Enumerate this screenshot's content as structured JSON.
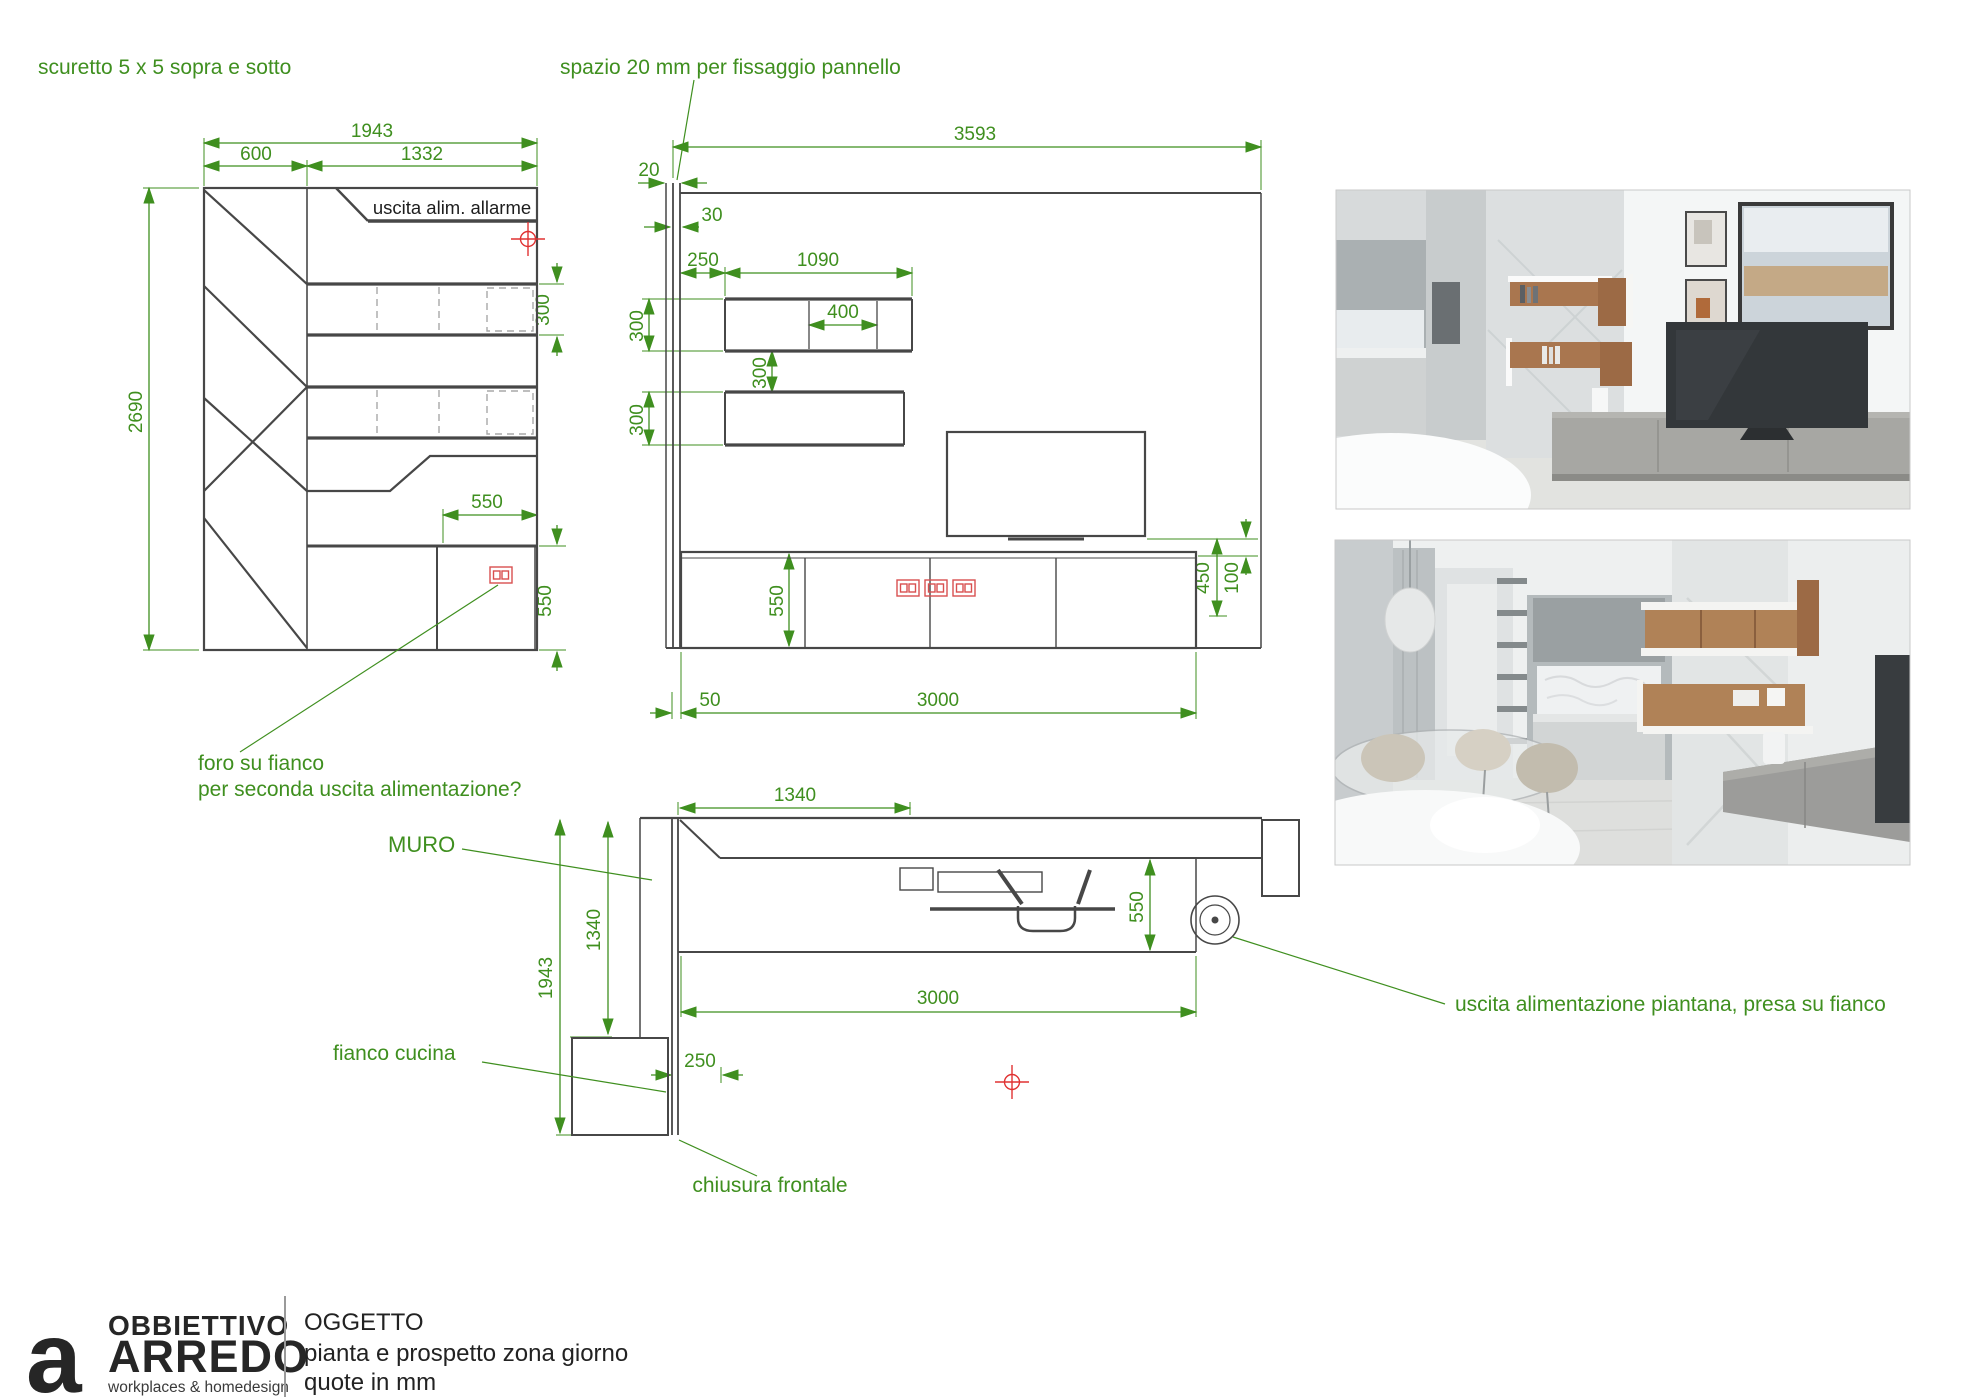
{
  "notes": {
    "scuretto": "scuretto 5 x 5 sopra e sotto",
    "spazio": "spazio 20 mm per fissaggio pannello",
    "foro_line1": "foro su fianco",
    "foro_line2": "per seconda uscita alimentazione?",
    "muro": "MURO",
    "fianco_cucina": "fianco cucina",
    "chiusura_frontale": "chiusura frontale",
    "uscita_piantana": "uscita alimentazione piantana, presa su fianco"
  },
  "front": {
    "label_allarme": "uscita alim. allarme",
    "w_total": "1943",
    "w_left": "600",
    "w_right": "1332",
    "h_total": "2690",
    "shelf_h": "300",
    "base_w": "550",
    "base_h": "550"
  },
  "elev": {
    "w_total": "3593",
    "gap": "20",
    "panel": "30",
    "offset": "250",
    "shelf_w": "1090",
    "shelf_inner": "400",
    "shelf1_h": "300",
    "shelf_gap": "300",
    "shelf2_h": "300",
    "base_h": "550",
    "tv_h": "450",
    "tv_gap": "100",
    "base_off": "50",
    "base_w": "3000"
  },
  "plan": {
    "top_w": "1340",
    "depth": "550",
    "length": "3000",
    "wall_h": "1340",
    "side_h": "1943",
    "return_w": "250"
  },
  "titleblock": {
    "brand_glyph": "a",
    "brand_line1": "OBBIETTIVO",
    "brand_line2": "ARREDO",
    "brand_tagline": "workplaces & homedesign",
    "object_label": "OGGETTO",
    "object_line1": "pianta e prospetto zona giorno",
    "object_line2": "quote in mm"
  },
  "colors": {
    "dimension_green": "#3f8f1f",
    "drawing_gray": "#474747",
    "accent_red": "#e03232"
  }
}
